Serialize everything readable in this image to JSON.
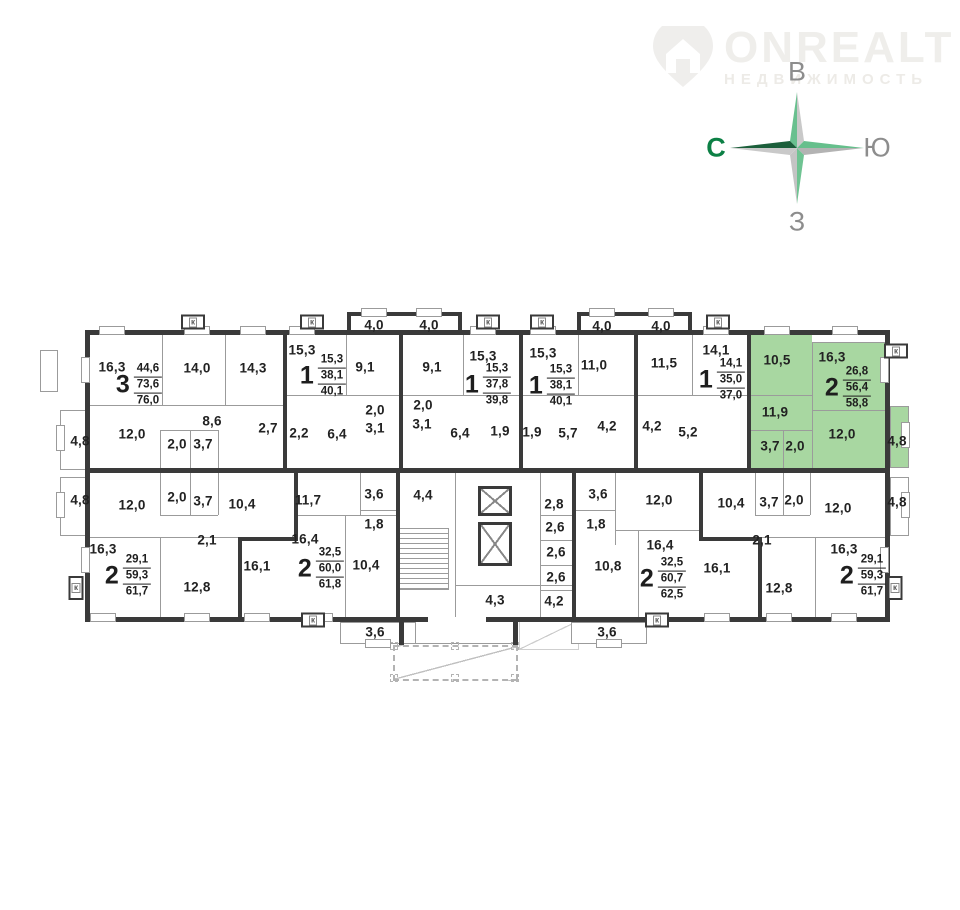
{
  "logo": {
    "name": "ONREALT",
    "subtitle": "НЕДВИЖИМОСТЬ"
  },
  "compass": {
    "top": "В",
    "left": "С",
    "right": "Ю",
    "bottom": "З"
  },
  "colors": {
    "highlight": "#a8d7a1",
    "wall": "#3a3a3a",
    "thin_wall": "#9b9b9b",
    "compass_green": "#5fbe8b",
    "compass_dark_green": "#1c5f3b",
    "compass_gray": "#c6c6c6",
    "north_letter_green": "#0c8045",
    "letter_gray": "#8d8d8d"
  },
  "vent_label": "к",
  "apartments": [
    {
      "n": "3",
      "a": [
        "44,6",
        "73,6",
        "76,0"
      ],
      "x": 139,
      "y": 385,
      "h": false
    },
    {
      "n": "1",
      "a": [
        "15,3",
        "38,1",
        "40,1"
      ],
      "x": 323,
      "y": 376,
      "h": false
    },
    {
      "n": "1",
      "a": [
        "15,3",
        "37,8",
        "39,8"
      ],
      "x": 488,
      "y": 385,
      "h": false
    },
    {
      "n": "1",
      "a": [
        "15,3",
        "38,1",
        "40,1"
      ],
      "x": 552,
      "y": 386,
      "h": false
    },
    {
      "n": "1",
      "a": [
        "14,1",
        "35,0",
        "37,0"
      ],
      "x": 722,
      "y": 380,
      "h": false
    },
    {
      "n": "2",
      "a": [
        "26,8",
        "56,4",
        "58,8"
      ],
      "x": 848,
      "y": 388,
      "h": true
    },
    {
      "n": "2",
      "a": [
        "29,1",
        "59,3",
        "61,7"
      ],
      "x": 128,
      "y": 576,
      "h": false
    },
    {
      "n": "2",
      "a": [
        "32,5",
        "60,0",
        "61,8"
      ],
      "x": 321,
      "y": 569,
      "h": false
    },
    {
      "n": "2",
      "a": [
        "32,5",
        "60,7",
        "62,5"
      ],
      "x": 663,
      "y": 579,
      "h": false
    },
    {
      "n": "2",
      "a": [
        "29,1",
        "59,3",
        "61,7"
      ],
      "x": 863,
      "y": 576,
      "h": false
    }
  ],
  "rooms": [
    {
      "t": "16,3",
      "x": 112,
      "y": 367,
      "h": false
    },
    {
      "t": "14,0",
      "x": 197,
      "y": 368,
      "h": false
    },
    {
      "t": "14,3",
      "x": 253,
      "y": 368,
      "h": false
    },
    {
      "t": "15,3",
      "x": 302,
      "y": 350,
      "h": false
    },
    {
      "t": "4,0",
      "x": 374,
      "y": 325,
      "h": false
    },
    {
      "t": "4,0",
      "x": 429,
      "y": 325,
      "h": false
    },
    {
      "t": "9,1",
      "x": 365,
      "y": 367,
      "h": false
    },
    {
      "t": "9,1",
      "x": 432,
      "y": 367,
      "h": false
    },
    {
      "t": "15,3",
      "x": 483,
      "y": 356,
      "h": false
    },
    {
      "t": "15,3",
      "x": 543,
      "y": 353,
      "h": false
    },
    {
      "t": "4,0",
      "x": 602,
      "y": 326,
      "h": false
    },
    {
      "t": "4,0",
      "x": 661,
      "y": 326,
      "h": false
    },
    {
      "t": "11,0",
      "x": 594,
      "y": 365,
      "h": false
    },
    {
      "t": "11,5",
      "x": 664,
      "y": 363,
      "h": false
    },
    {
      "t": "14,1",
      "x": 716,
      "y": 350,
      "h": false
    },
    {
      "t": "10,5",
      "x": 777,
      "y": 360,
      "h": true
    },
    {
      "t": "16,3",
      "x": 832,
      "y": 357,
      "h": true
    },
    {
      "t": "8,6",
      "x": 212,
      "y": 421,
      "h": false
    },
    {
      "t": "2,7",
      "x": 268,
      "y": 428,
      "h": false
    },
    {
      "t": "12,0",
      "x": 132,
      "y": 434,
      "h": false
    },
    {
      "t": "4,8",
      "x": 80,
      "y": 441,
      "h": false
    },
    {
      "t": "2,0",
      "x": 177,
      "y": 444,
      "h": false
    },
    {
      "t": "3,7",
      "x": 203,
      "y": 444,
      "h": false
    },
    {
      "t": "2,2",
      "x": 299,
      "y": 433,
      "h": false
    },
    {
      "t": "6,4",
      "x": 337,
      "y": 434,
      "h": false
    },
    {
      "t": "2,0",
      "x": 375,
      "y": 410,
      "h": false
    },
    {
      "t": "3,1",
      "x": 375,
      "y": 428,
      "h": false
    },
    {
      "t": "2,0",
      "x": 423,
      "y": 405,
      "h": false
    },
    {
      "t": "3,1",
      "x": 422,
      "y": 424,
      "h": false
    },
    {
      "t": "6,4",
      "x": 460,
      "y": 433,
      "h": false
    },
    {
      "t": "1,9",
      "x": 500,
      "y": 431,
      "h": false
    },
    {
      "t": "1,9",
      "x": 532,
      "y": 432,
      "h": false
    },
    {
      "t": "5,7",
      "x": 568,
      "y": 433,
      "h": false
    },
    {
      "t": "4,2",
      "x": 607,
      "y": 426,
      "h": false
    },
    {
      "t": "4,2",
      "x": 652,
      "y": 426,
      "h": false
    },
    {
      "t": "5,2",
      "x": 688,
      "y": 432,
      "h": false
    },
    {
      "t": "11,9",
      "x": 775,
      "y": 412,
      "h": true
    },
    {
      "t": "3,7",
      "x": 770,
      "y": 446,
      "h": true
    },
    {
      "t": "2,0",
      "x": 795,
      "y": 446,
      "h": true
    },
    {
      "t": "12,0",
      "x": 842,
      "y": 434,
      "h": true
    },
    {
      "t": "4,8",
      "x": 897,
      "y": 441,
      "h": true
    },
    {
      "t": "4,8",
      "x": 80,
      "y": 500,
      "h": false
    },
    {
      "t": "12,0",
      "x": 132,
      "y": 505,
      "h": false
    },
    {
      "t": "2,0",
      "x": 177,
      "y": 497,
      "h": false
    },
    {
      "t": "3,7",
      "x": 203,
      "y": 501,
      "h": false
    },
    {
      "t": "10,4",
      "x": 242,
      "y": 504,
      "h": false
    },
    {
      "t": "16,3",
      "x": 103,
      "y": 549,
      "h": false
    },
    {
      "t": "2,1",
      "x": 207,
      "y": 540,
      "h": false
    },
    {
      "t": "12,8",
      "x": 197,
      "y": 587,
      "h": false
    },
    {
      "t": "16,1",
      "x": 257,
      "y": 566,
      "h": false
    },
    {
      "t": "11,7",
      "x": 308,
      "y": 500,
      "h": false
    },
    {
      "t": "3,6",
      "x": 374,
      "y": 494,
      "h": false
    },
    {
      "t": "4,4",
      "x": 423,
      "y": 495,
      "h": false
    },
    {
      "t": "1,8",
      "x": 374,
      "y": 524,
      "h": false
    },
    {
      "t": "16,4",
      "x": 305,
      "y": 539,
      "h": false
    },
    {
      "t": "10,4",
      "x": 366,
      "y": 565,
      "h": false
    },
    {
      "t": "3,6",
      "x": 375,
      "y": 632,
      "h": false
    },
    {
      "t": "4,3",
      "x": 495,
      "y": 600,
      "h": false
    },
    {
      "t": "4,2",
      "x": 554,
      "y": 601,
      "h": false
    },
    {
      "t": "2,8",
      "x": 554,
      "y": 504,
      "h": false
    },
    {
      "t": "2,6",
      "x": 555,
      "y": 527,
      "h": false
    },
    {
      "t": "2,6",
      "x": 556,
      "y": 552,
      "h": false
    },
    {
      "t": "2,6",
      "x": 556,
      "y": 577,
      "h": false
    },
    {
      "t": "3,6",
      "x": 598,
      "y": 494,
      "h": false
    },
    {
      "t": "1,8",
      "x": 596,
      "y": 524,
      "h": false
    },
    {
      "t": "12,0",
      "x": 659,
      "y": 500,
      "h": false
    },
    {
      "t": "16,4",
      "x": 660,
      "y": 545,
      "h": false
    },
    {
      "t": "10,8",
      "x": 608,
      "y": 566,
      "h": false
    },
    {
      "t": "3,6",
      "x": 607,
      "y": 632,
      "h": false
    },
    {
      "t": "16,1",
      "x": 717,
      "y": 568,
      "h": false
    },
    {
      "t": "10,4",
      "x": 731,
      "y": 503,
      "h": false
    },
    {
      "t": "3,7",
      "x": 769,
      "y": 502,
      "h": false
    },
    {
      "t": "2,0",
      "x": 794,
      "y": 500,
      "h": false
    },
    {
      "t": "12,0",
      "x": 838,
      "y": 508,
      "h": false
    },
    {
      "t": "4,8",
      "x": 897,
      "y": 502,
      "h": false
    },
    {
      "t": "2,1",
      "x": 762,
      "y": 540,
      "h": false
    },
    {
      "t": "16,3",
      "x": 844,
      "y": 549,
      "h": false
    },
    {
      "t": "12,8",
      "x": 779,
      "y": 588,
      "h": false
    }
  ],
  "vents": [
    {
      "x": 193,
      "y": 322,
      "o": "h"
    },
    {
      "x": 312,
      "y": 322,
      "o": "h"
    },
    {
      "x": 488,
      "y": 322,
      "o": "h"
    },
    {
      "x": 542,
      "y": 322,
      "o": "h"
    },
    {
      "x": 718,
      "y": 322,
      "o": "h"
    },
    {
      "x": 896,
      "y": 351,
      "o": "h"
    },
    {
      "x": 76,
      "y": 588,
      "o": "v"
    },
    {
      "x": 313,
      "y": 620,
      "o": "h"
    },
    {
      "x": 657,
      "y": 620,
      "o": "h"
    },
    {
      "x": 895,
      "y": 588,
      "o": "v"
    }
  ]
}
